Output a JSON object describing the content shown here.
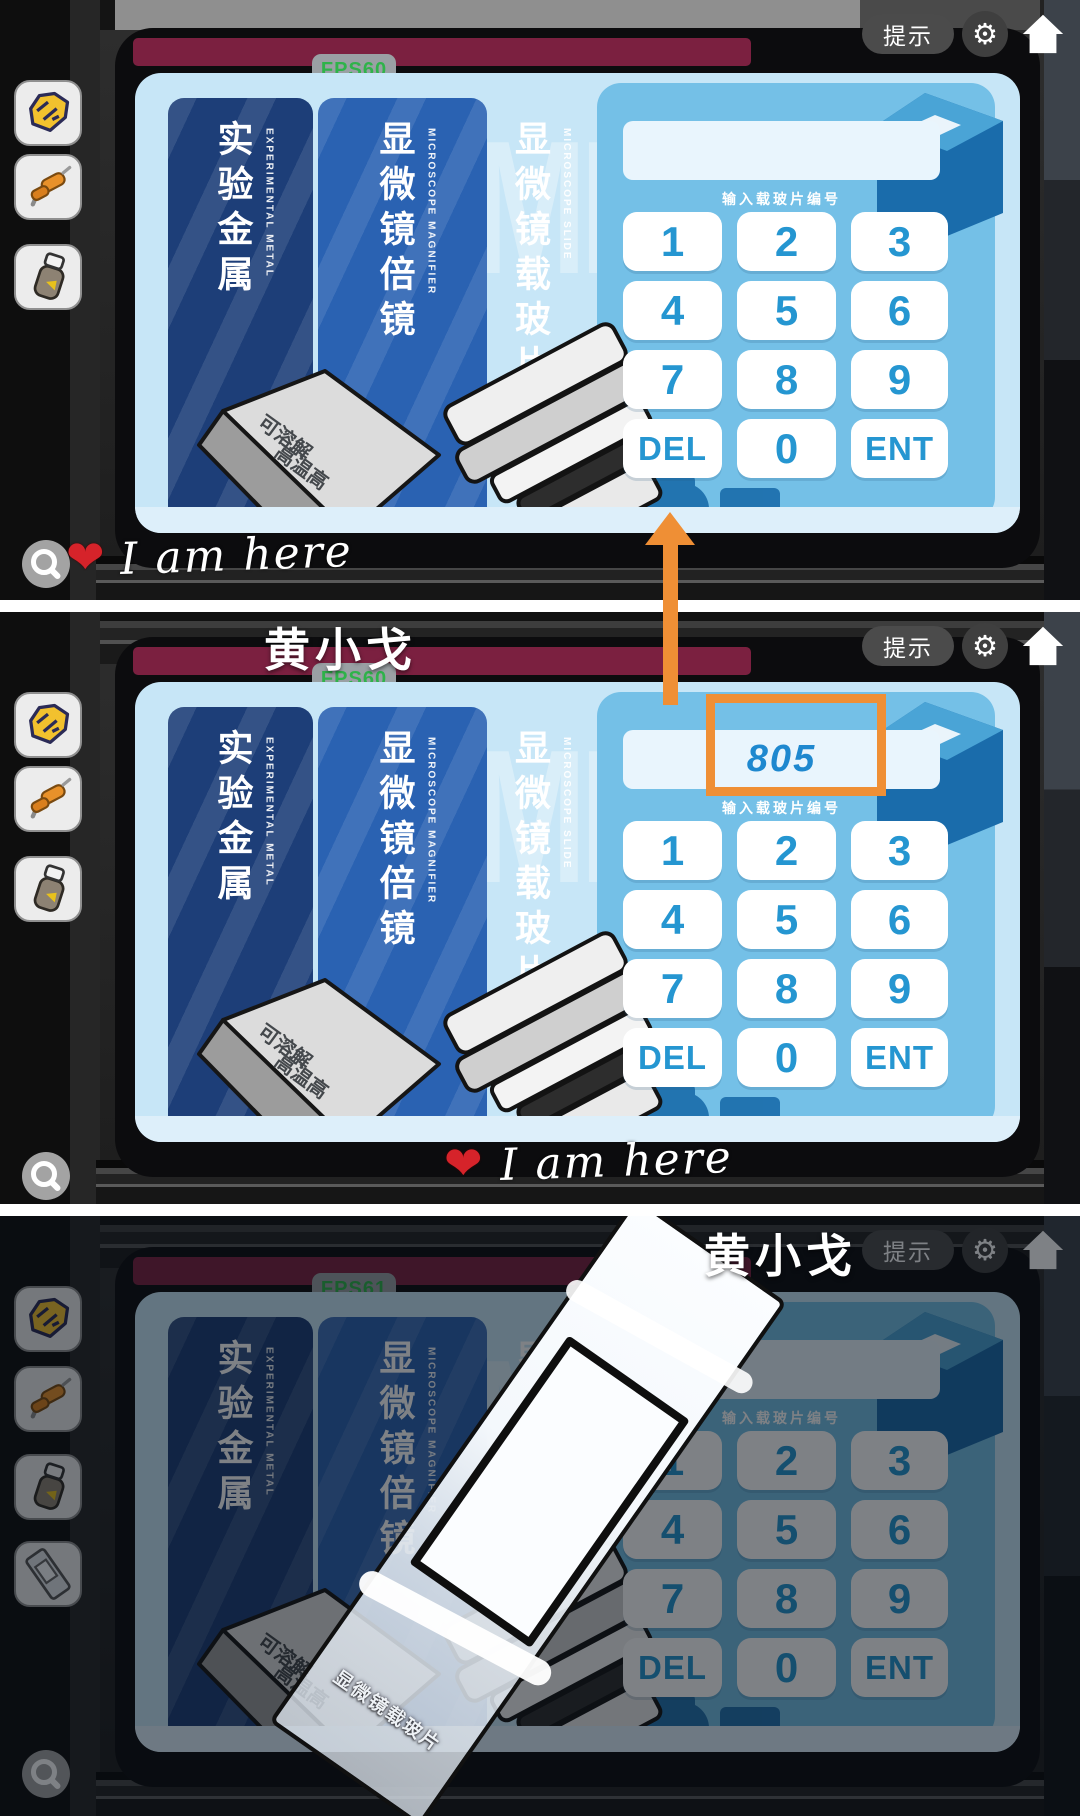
{
  "hud": {
    "hint_button": "提示"
  },
  "annotations": {
    "i_am_here": "I am here",
    "heart": "❤",
    "watermark_name": "黄小戈"
  },
  "panels": [
    {
      "fps": "FPS60",
      "input_value": ""
    },
    {
      "fps": "FPS60",
      "input_value": "805"
    },
    {
      "fps": "FPS61",
      "input_value": ""
    }
  ],
  "keypad": {
    "label": "输入载玻片编号",
    "keys": [
      "1",
      "2",
      "3",
      "4",
      "5",
      "6",
      "7",
      "8",
      "9",
      "DEL",
      "0",
      "ENT"
    ]
  },
  "columns": [
    {
      "cn": "实验金属",
      "en": "EXPERIMENTAL METAL"
    },
    {
      "cn": "显微镜倍镜",
      "en": "MICROSCOPE MAGNIFIER"
    },
    {
      "cn": "显微镜载玻片",
      "en": "MICROSCOPE SLIDE"
    }
  ],
  "screen": {
    "watermark_letters": "MIC"
  },
  "slide": {
    "label": "显微镜载玻片"
  },
  "ingot": {
    "line1": "可溶解",
    "line2": "高温高"
  },
  "icons": [
    "metal-scrap-icon",
    "wire-tool-icon",
    "reagent-bottle-icon",
    "slide-item-icon",
    "magnifier-icon",
    "gear-icon",
    "home-icon",
    "search-icon"
  ],
  "colors": {
    "annotation_orange": "#ef8f35",
    "annotation_red": "#d6232a",
    "fps_green": "#2fb34a",
    "key_text_blue": "#2596d1",
    "entered_value_blue": "#1e88cf",
    "screen_blue": "#c7e6f7",
    "keypad_zone_blue": "#74c0e7",
    "column1_navy": "#1d3e78",
    "column2_blue": "#2a62b2",
    "maroon_bar": "#7b2040"
  }
}
